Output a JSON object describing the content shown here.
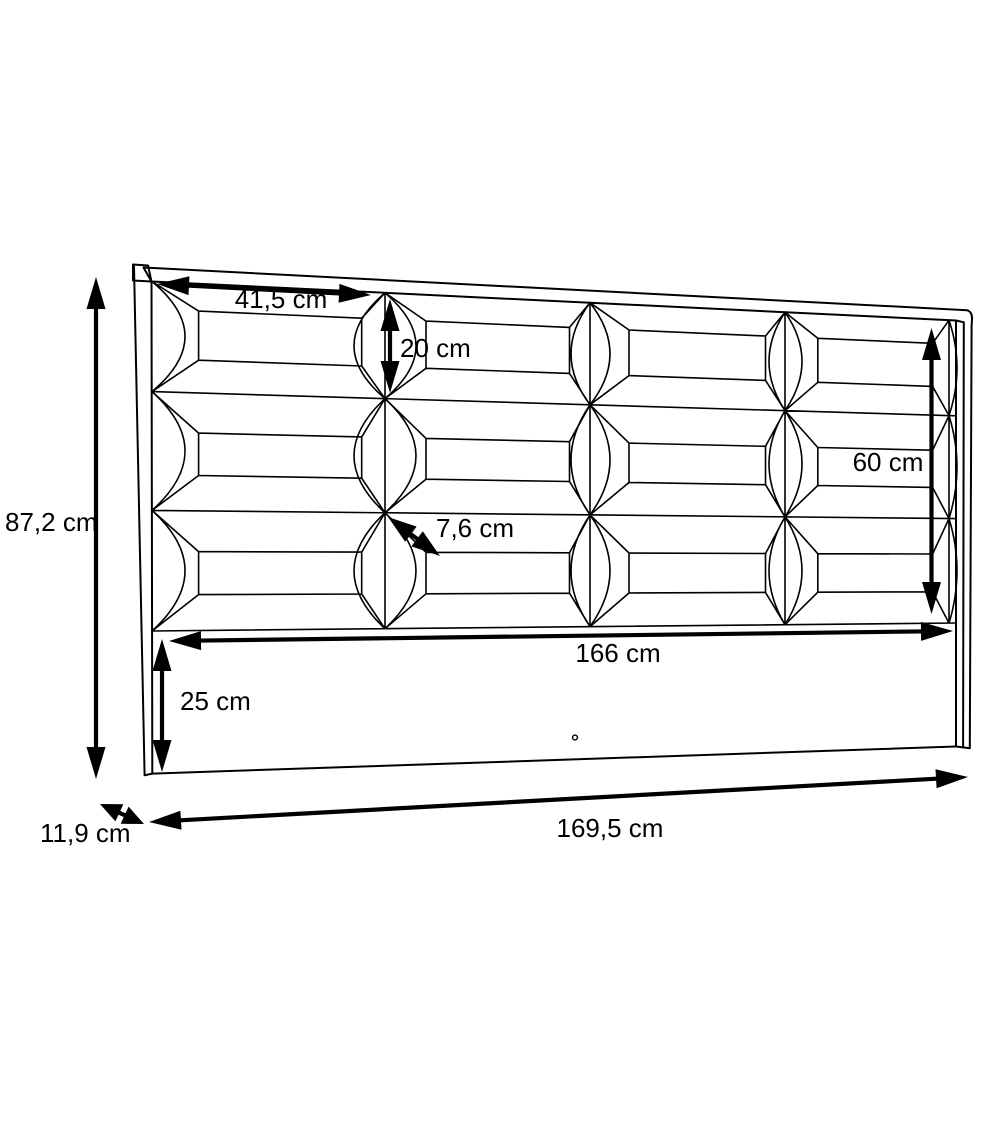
{
  "drawing": {
    "background_color": "#ffffff",
    "line_color": "#000000",
    "dimensions": {
      "overall_height": {
        "label": "87,2 cm"
      },
      "panel_width": {
        "label": "41,5 cm"
      },
      "panel_row_height": {
        "label": "20 cm"
      },
      "padded_area_height": {
        "label": "60 cm"
      },
      "cushion_depth": {
        "label": "7,6 cm"
      },
      "inner_width": {
        "label": "166 cm"
      },
      "base_board_height": {
        "label": "25 cm"
      },
      "side_depth": {
        "label": "11,9 cm"
      },
      "overall_width": {
        "label": "169,5 cm"
      }
    }
  }
}
